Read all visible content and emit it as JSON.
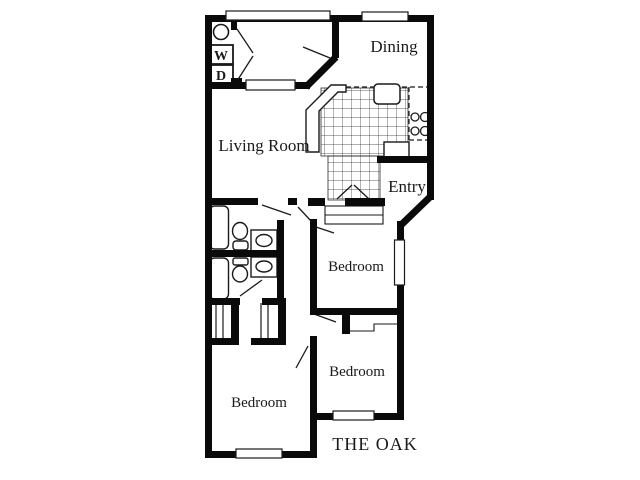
{
  "plan": {
    "title": "THE OAK",
    "rooms": {
      "living_room": {
        "label": "Living Room"
      },
      "dining": {
        "label": "Dining"
      },
      "entry": {
        "label": "Entry"
      },
      "bedroom_right": {
        "label": "Bedroom"
      },
      "bedroom_bottom_right": {
        "label": "Bedroom"
      },
      "bedroom_bottom_left": {
        "label": "Bedroom"
      }
    },
    "appliances": {
      "washer": "W",
      "dryer": "D"
    },
    "icons": [
      "washer-circle-icon",
      "bathtub-icon",
      "toilet-icon",
      "vanity-sink-icon",
      "kitchen-sink-icon",
      "stove-burners-icon",
      "refrigerator-icon",
      "bar-counter-icon",
      "closet-rod-icon",
      "door-swing-icon",
      "window-icon",
      "tile-floor-icon"
    ],
    "colors": {
      "walls": "#0a0a0a",
      "background": "#ffffff",
      "tile_lines": "#2a2a2a"
    }
  }
}
